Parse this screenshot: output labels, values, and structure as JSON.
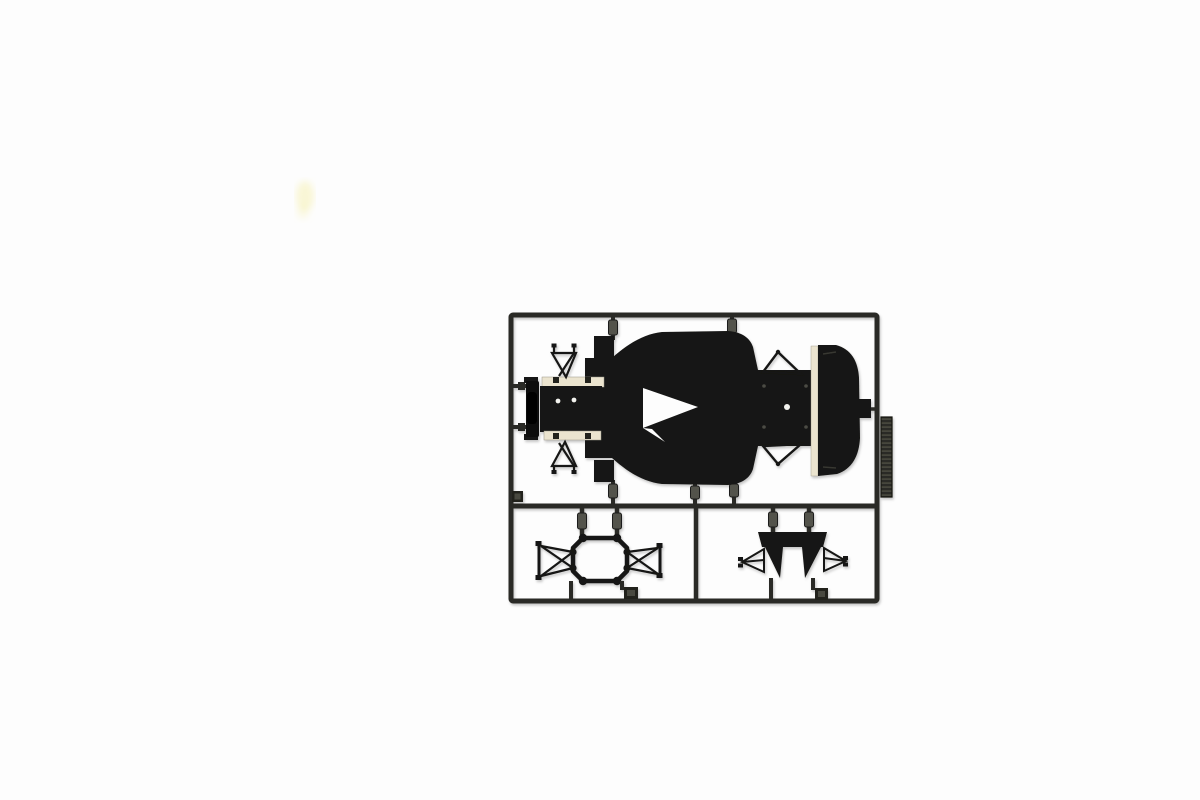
{
  "scene": {
    "type": "product-photo",
    "alt": "Top-down photo of a black plastic model-kit sprue (parts tree) on a plain white background. The rectangular runner frame holds Formula 1 car parts: a large chassis undertray with cockpit notch, a rounded engine cover, a front bulkhead with cream mounting plates and wire wishbones, a ribbed radiator plate on the right rail, and two suspension sub-assemblies in the lower cells.",
    "background": "#fdfdfd"
  },
  "colors": {
    "background": "#fdfdfd",
    "runner": "#2a2a26",
    "plastic": "#141412",
    "plastic_deep": "#0c0c0b",
    "pin": "#53534b",
    "cream": "#ebe4cf",
    "gate_block": "#23231f",
    "gate_inner": "#4a4a40",
    "smudge": "#f7f2c0"
  },
  "parts": {
    "frame": "Sprue outer runner frame",
    "divider_h": "Horizontal runner divider",
    "divider_v": "Vertical runner divider (lower cells)",
    "chassis": "Chassis undertray, top view",
    "cockpit_notch": "Cockpit opening notch",
    "nose_box_upper": "Upper nose block",
    "nose_box_lower": "Lower nose block",
    "front_bulkhead": "Front bulkhead with cream mounting plates",
    "front_wishbone_upper": "Front upper wishbone (wire triangle)",
    "front_wishbone_lower": "Front lower wishbone (wire triangle)",
    "rear_wishbone_upper": "Rear upper wishbone (wire triangle)",
    "rear_wishbone_lower": "Rear lower wishbone (wire triangle)",
    "engine_cover": "Rear engine cover with cream edge strip",
    "radiator": "Ribbed radiator plate on right rail",
    "front_suspension_assembly": "Front suspension sub-frame (octagonal ring with lattice arms)",
    "rear_suspension_assembly": "Rear suspension cross-member with solid wedges and lattice arms",
    "gate_pins": "Molding gate pins and runners",
    "gate_tabs": "Molding gate tabs",
    "smudge": "Faint yellow smudge on the backdrop"
  }
}
